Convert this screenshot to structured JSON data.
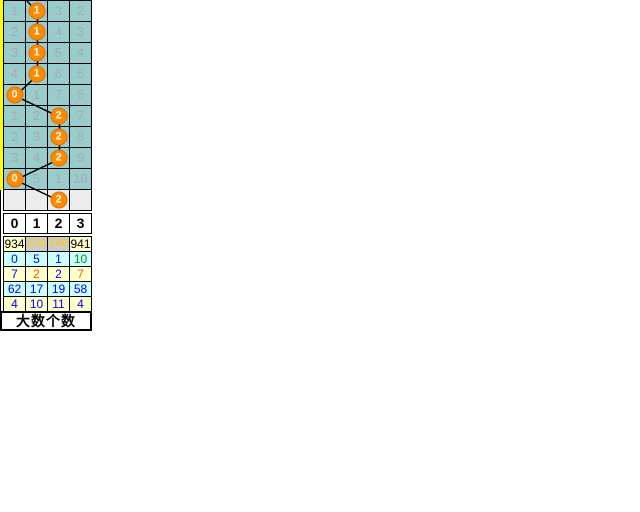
{
  "colors": {
    "cell_bg": "#99cccc",
    "cell_text": "#aaaaaa",
    "pending_bg": "#ededed",
    "circle_bg": "#ff8a00",
    "circle_border": "#e06f00",
    "circle_text": "#ffffff",
    "line": "#000000",
    "yellow_strip": "#ffff00",
    "stat_yellow_bg": "#ffffcc",
    "stat_cyan_bg": "#ccffff",
    "stat_gray_bg": "#cccccc",
    "stat_blue": "#0000ff",
    "stat_green": "#009900",
    "stat_red": "#ff5500",
    "stat_highlight_text": "#ffcc00"
  },
  "chart_data": {
    "type": "table",
    "title": "大数个数",
    "column_headers": [
      "0",
      "1",
      "2",
      "3"
    ],
    "rows": [
      {
        "cells": [
          "1",
          "1",
          "3",
          "2"
        ],
        "hit_col": 1,
        "hit_value": "1",
        "pending": false
      },
      {
        "cells": [
          "2",
          "1",
          "4",
          "3"
        ],
        "hit_col": 1,
        "hit_value": "1",
        "pending": false
      },
      {
        "cells": [
          "3",
          "1",
          "5",
          "4"
        ],
        "hit_col": 1,
        "hit_value": "1",
        "pending": false
      },
      {
        "cells": [
          "4",
          "1",
          "6",
          "5"
        ],
        "hit_col": 1,
        "hit_value": "1",
        "pending": false
      },
      {
        "cells": [
          "0",
          "1",
          "7",
          "6"
        ],
        "hit_col": 0,
        "hit_value": "0",
        "pending": false
      },
      {
        "cells": [
          "1",
          "2",
          "2",
          "7"
        ],
        "hit_col": 2,
        "hit_value": "2",
        "pending": false
      },
      {
        "cells": [
          "2",
          "3",
          "2",
          "8"
        ],
        "hit_col": 2,
        "hit_value": "2",
        "pending": false
      },
      {
        "cells": [
          "3",
          "4",
          "2",
          "9"
        ],
        "hit_col": 2,
        "hit_value": "2",
        "pending": false
      },
      {
        "cells": [
          "0",
          "5",
          "1",
          "10"
        ],
        "hit_col": 0,
        "hit_value": "0",
        "pending": false
      },
      {
        "cells": [
          "",
          "",
          "",
          ""
        ],
        "hit_col": 2,
        "hit_value": "2",
        "pending": true
      }
    ],
    "hit_column_per_row": [
      1,
      1,
      1,
      1,
      0,
      2,
      2,
      2,
      0,
      2
    ],
    "stats_rows": [
      {
        "cells": [
          {
            "text": "934",
            "color": "#000000",
            "bg": "#ffffcc"
          },
          {
            "text": "2732",
            "color": "#ffcc00",
            "bg": "#cccccc"
          },
          {
            "text": "2750",
            "color": "#ffcc00",
            "bg": "#cccccc"
          },
          {
            "text": "941",
            "color": "#000000",
            "bg": "#ffffcc"
          }
        ]
      },
      {
        "cells": [
          {
            "text": "0",
            "color": "#0000ff",
            "bg": "#ccffff"
          },
          {
            "text": "5",
            "color": "#0000ff",
            "bg": "#ccffff"
          },
          {
            "text": "1",
            "color": "#0000ff",
            "bg": "#ccffff"
          },
          {
            "text": "10",
            "color": "#009900",
            "bg": "#ccffff"
          }
        ]
      },
      {
        "cells": [
          {
            "text": "7",
            "color": "#0000ff",
            "bg": "#ffffcc"
          },
          {
            "text": "2",
            "color": "#ff5500",
            "bg": "#ffffcc"
          },
          {
            "text": "2",
            "color": "#0000ff",
            "bg": "#ffffcc"
          },
          {
            "text": "7",
            "color": "#ff5500",
            "bg": "#ffffcc"
          }
        ]
      },
      {
        "cells": [
          {
            "text": "62",
            "color": "#0000ff",
            "bg": "#ccffff"
          },
          {
            "text": "17",
            "color": "#0000ff",
            "bg": "#ccffff"
          },
          {
            "text": "19",
            "color": "#0000ff",
            "bg": "#ccffff"
          },
          {
            "text": "58",
            "color": "#0000ff",
            "bg": "#ccffff"
          }
        ]
      },
      {
        "cells": [
          {
            "text": "4",
            "color": "#0000ff",
            "bg": "#ffffcc"
          },
          {
            "text": "10",
            "color": "#0000ff",
            "bg": "#ffffcc"
          },
          {
            "text": "11",
            "color": "#0000ff",
            "bg": "#ffffcc"
          },
          {
            "text": "4",
            "color": "#0000ff",
            "bg": "#ffffcc"
          }
        ]
      }
    ]
  },
  "footer": {
    "label": "大数个数"
  }
}
